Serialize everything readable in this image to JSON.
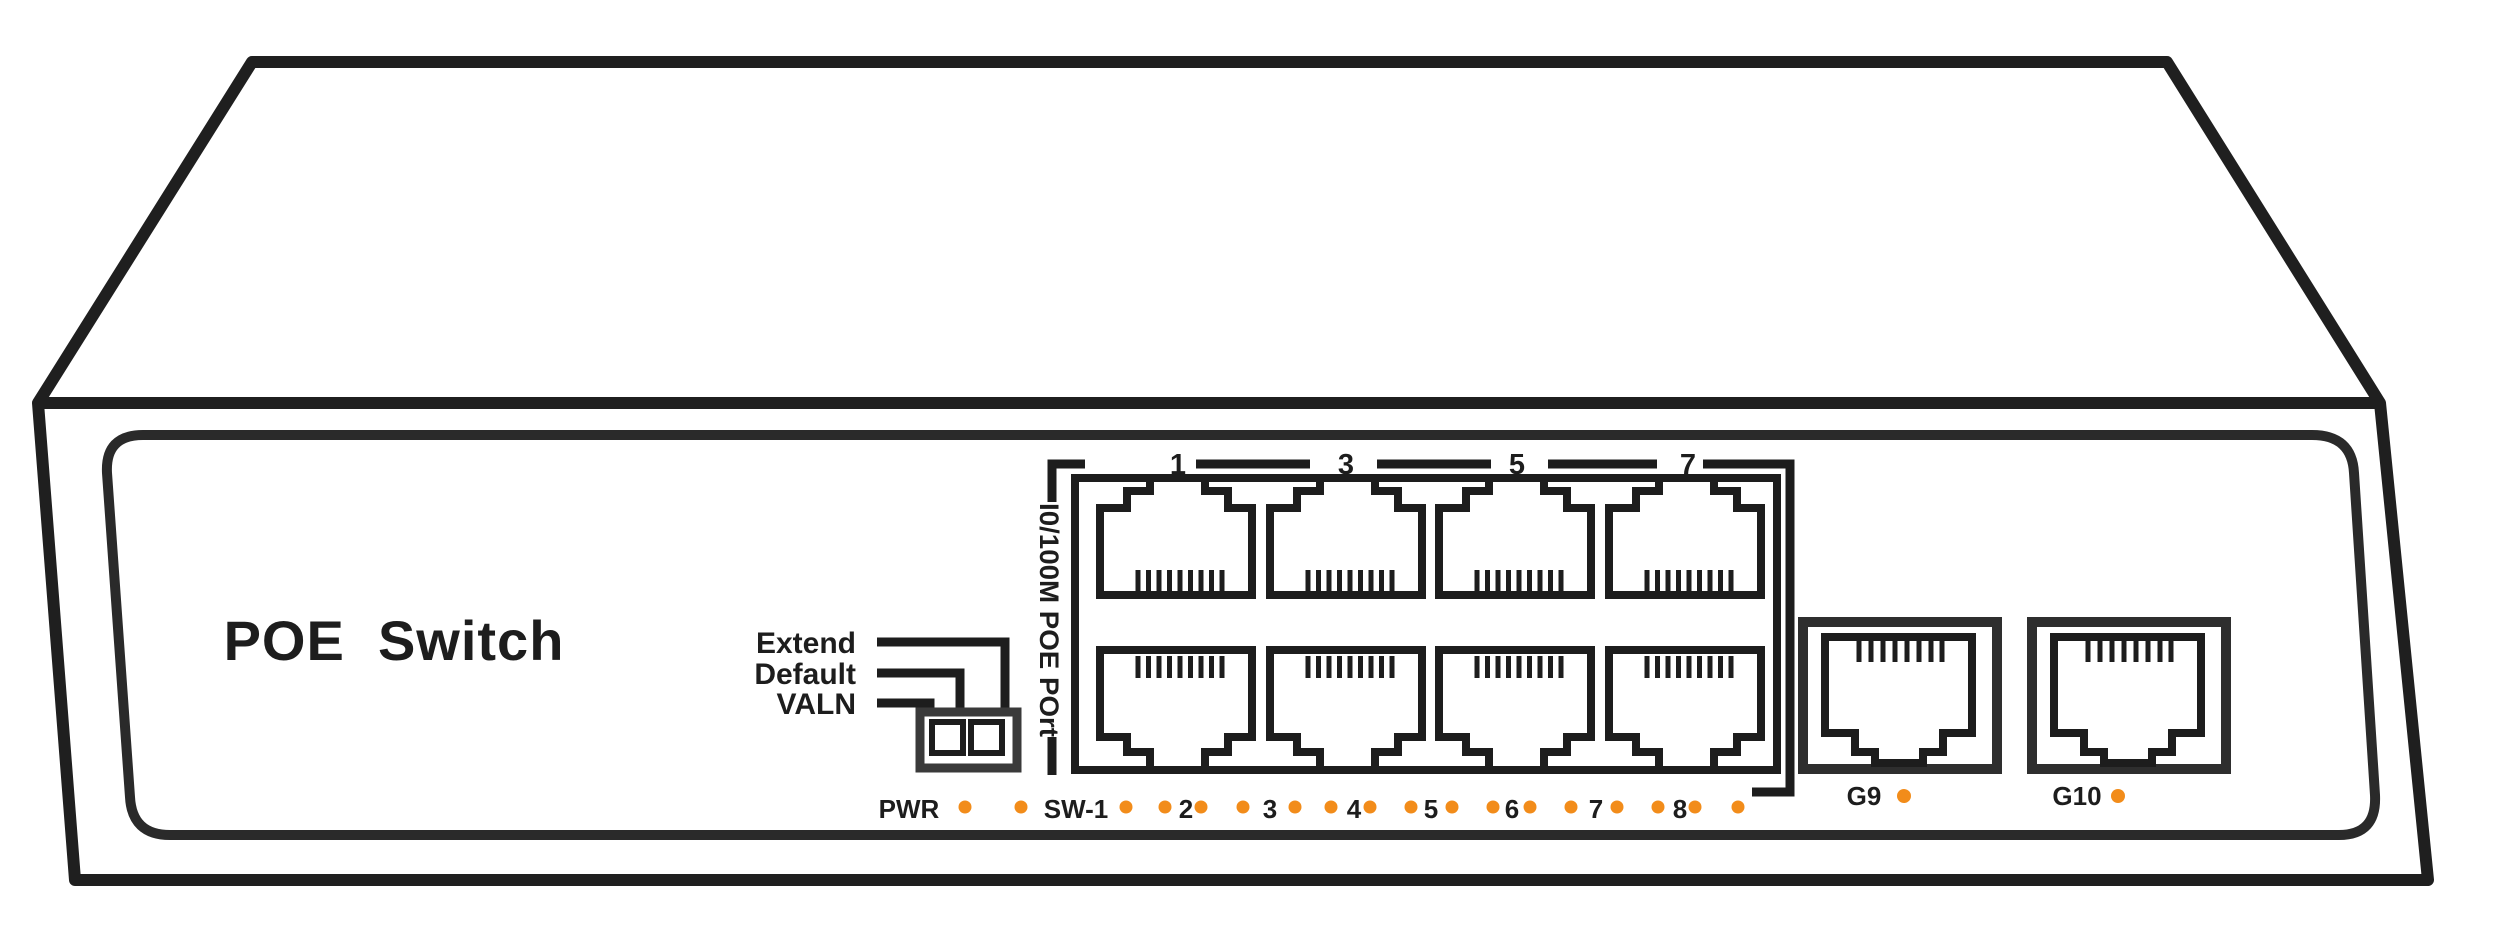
{
  "title": "POE  Switch",
  "dip_switch": {
    "labels": [
      "Extend",
      "Default",
      "VALN"
    ]
  },
  "port_group": {
    "label_vertical": "I0/100M POE POrt",
    "port_numbers": [
      "1",
      "3",
      "5",
      "7"
    ]
  },
  "led_row": {
    "power_label": "PWR",
    "switch_label": "SW-1",
    "port_labels": [
      "2",
      "3",
      "4",
      "5",
      "6",
      "7",
      "8"
    ]
  },
  "uplink_ports": {
    "g9_label": "G9",
    "g10_label": "G10"
  },
  "colors": {
    "ink": "#242424",
    "led_orange": "#F28C1A",
    "dip_gray": "#3A3A3A"
  }
}
